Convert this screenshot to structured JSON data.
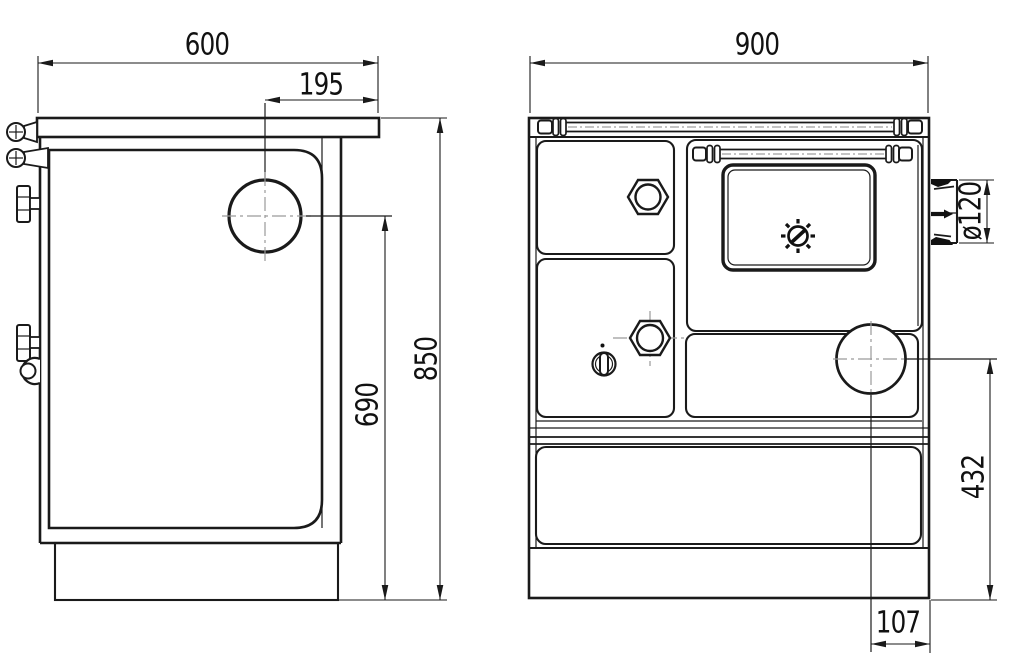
{
  "drawing": {
    "type": "technical-drawing",
    "subject": "wood-fired kitchen stove, side view and front view",
    "colors": {
      "line": "#1a1a1a",
      "centerline": "#9a9a9a",
      "background": "#ffffff"
    }
  },
  "side_view": {
    "dimensions": {
      "top_width": "600",
      "flue_offset": "195",
      "overall_height": "850",
      "flue_center_height": "690"
    }
  },
  "front_view": {
    "dimensions": {
      "overall_width": "900",
      "flue_diameter": "ø120",
      "outlet_height": "432",
      "outlet_offset": "107"
    }
  }
}
